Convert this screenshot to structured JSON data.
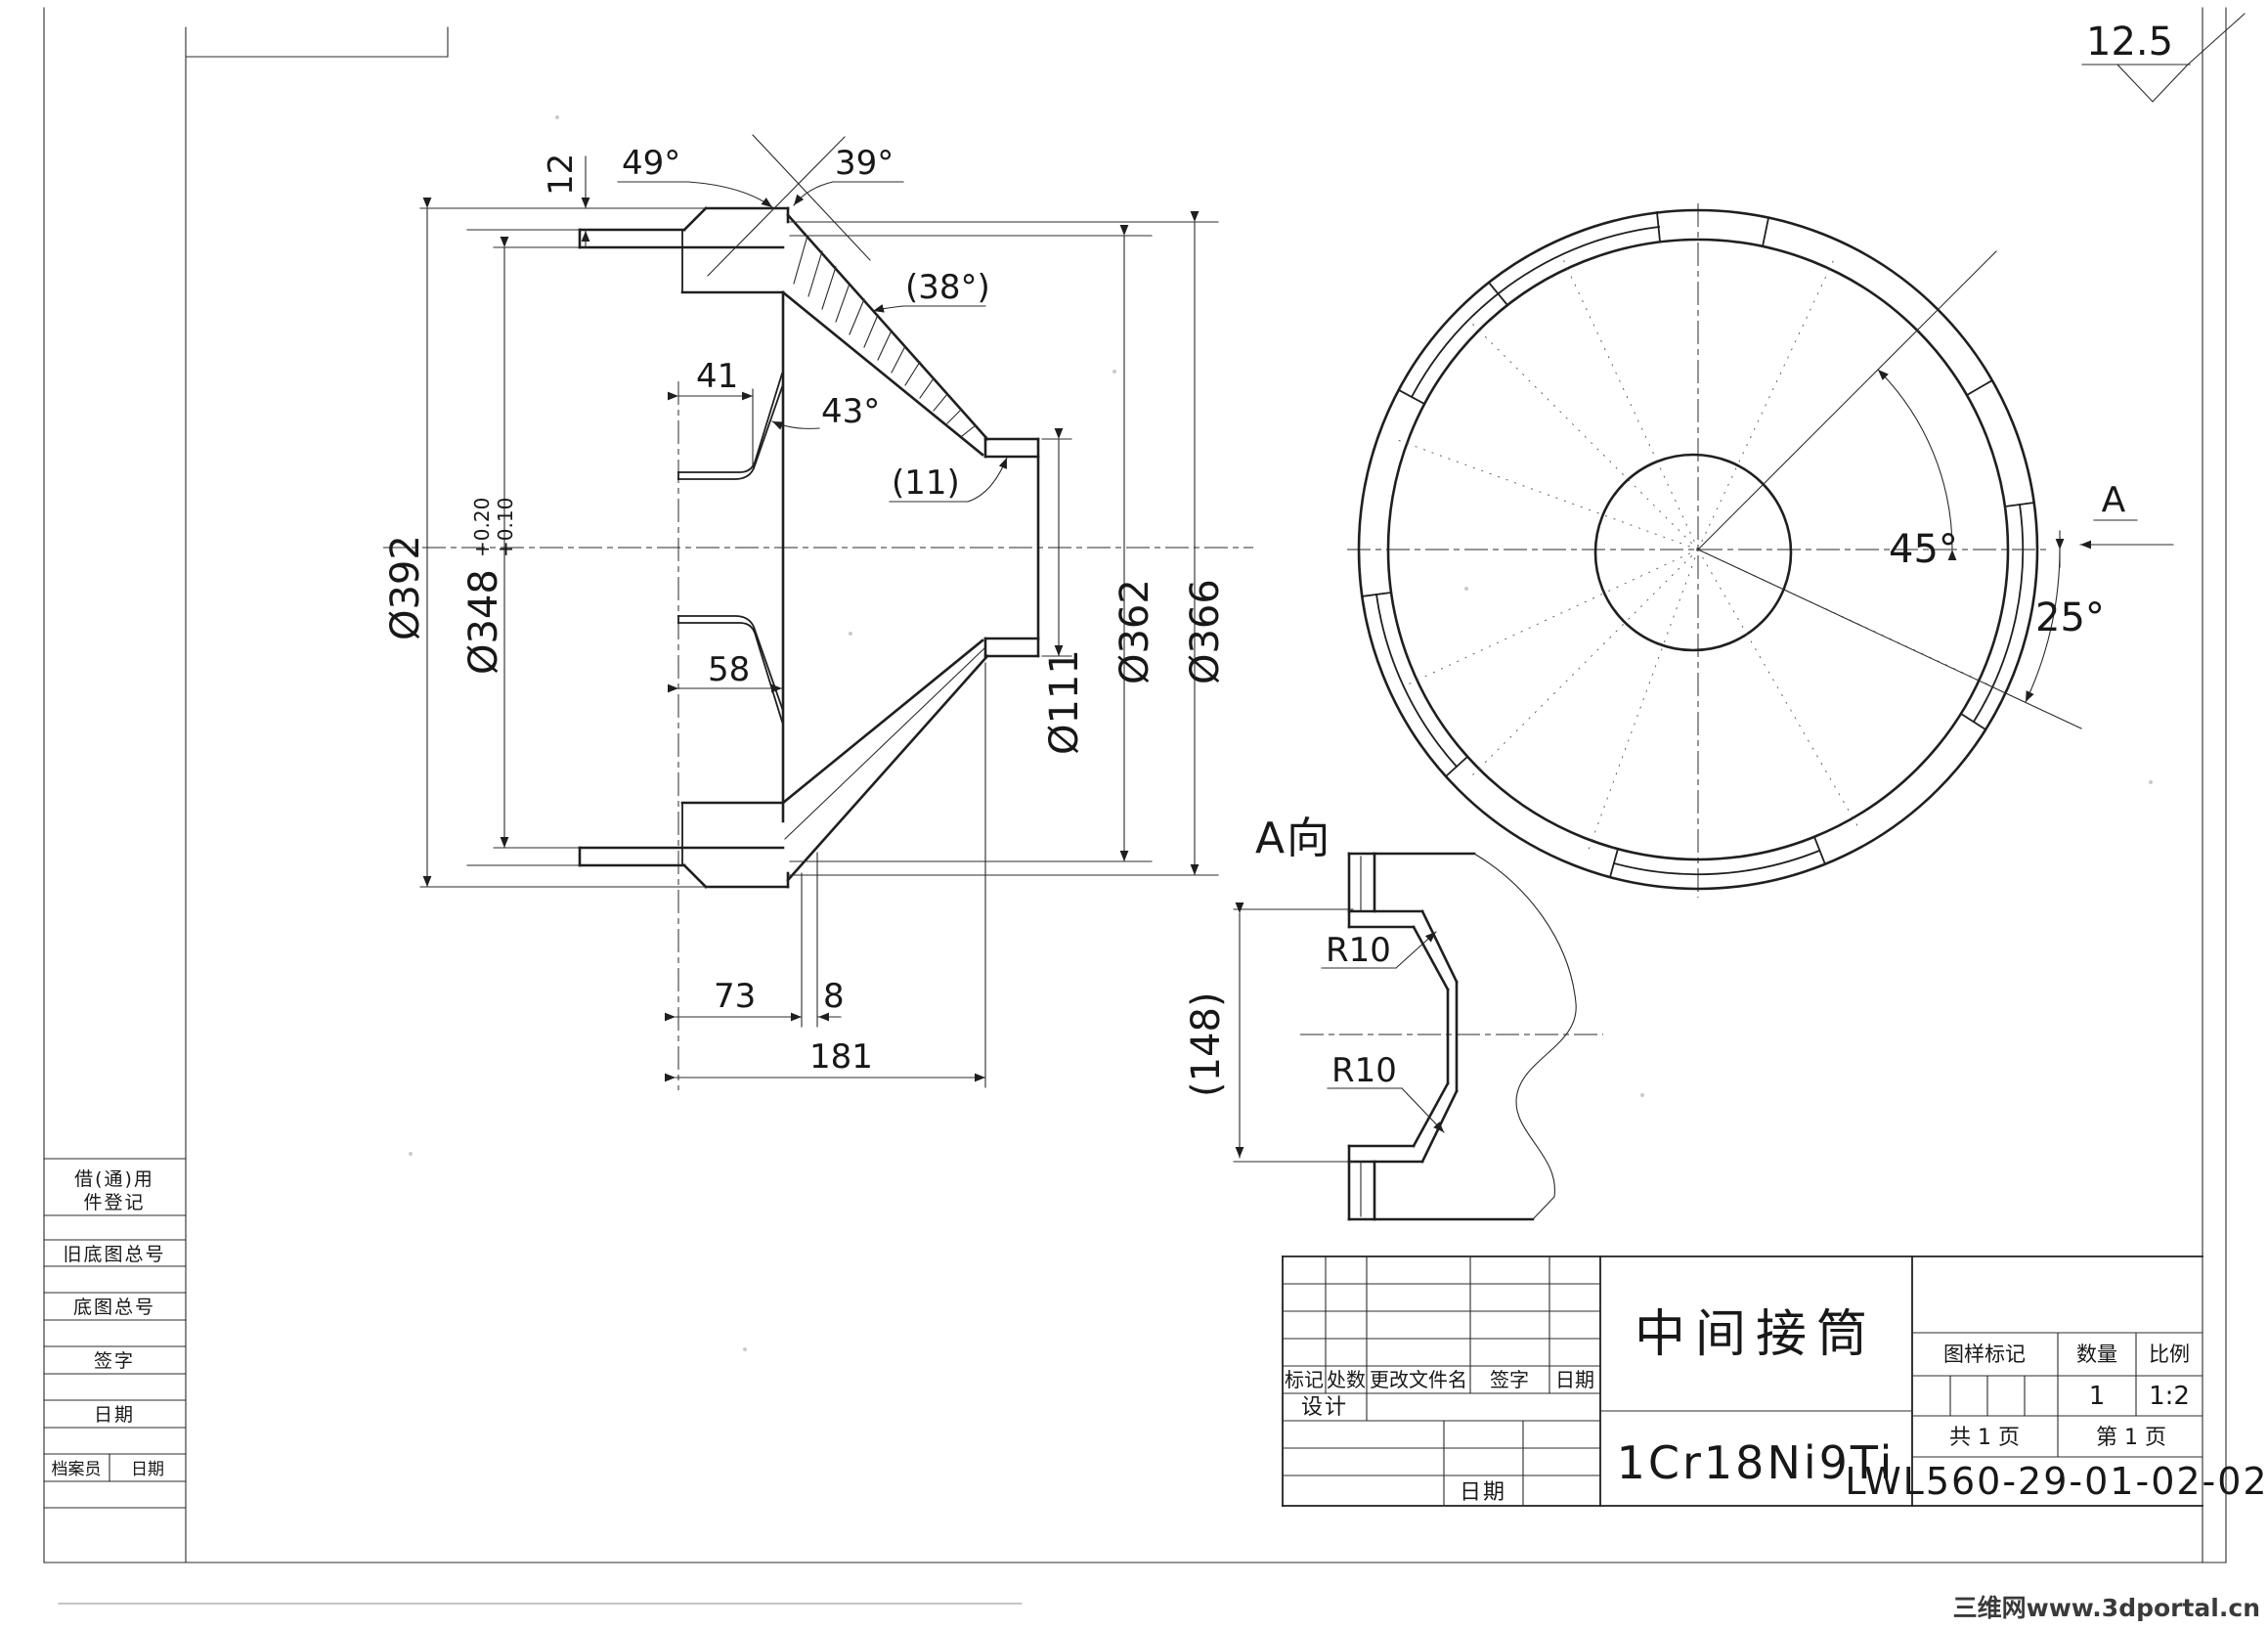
{
  "colors": {
    "ink": "#1f1f1f",
    "watermark_red": "#e04038",
    "paper": "#ffffff"
  },
  "surface_finish": {
    "roughness_value": "12.5"
  },
  "main_view": {
    "dim_12": "12",
    "angle_49": "49°",
    "angle_39": "39°",
    "angle_38": "(38°)",
    "dim_41": "41",
    "angle_43": "43°",
    "wall_11": "(11)",
    "dim_58": "58",
    "dim_73": "73",
    "dim_8": "8",
    "dim_181": "181",
    "dia_392": "Ø392",
    "dia_348": "Ø348",
    "dia_348_tol_up": "+0.20",
    "dia_348_tol_low": "+0.10",
    "dia_111": "Ø111",
    "dia_362": "Ø362",
    "dia_366": "Ø366"
  },
  "front_view": {
    "angle_45": "45°",
    "angle_25": "25°",
    "view_letter": "A"
  },
  "detail_view": {
    "label": "A向",
    "dim_148": "(148)",
    "radius_top": "R10",
    "radius_bottom": "R10"
  },
  "left_panel": {
    "row1_line1": "借(通)用",
    "row1_line2": "件登记",
    "row2": "旧底图总号",
    "row3": "底图总号",
    "row4": "签字",
    "row5": "日期",
    "row6_left": "档案员",
    "row6_right": "日期"
  },
  "title_block": {
    "rev_headers": [
      "标记",
      "处数",
      "更改文件名",
      "签字",
      "日期"
    ],
    "design_label": "设计",
    "date_label": "日期",
    "part_name": "中间接筒",
    "material": "1Cr18Ni9Ti",
    "stamp_label": "图样标记",
    "qty_label": "数量",
    "scale_label": "比例",
    "qty_value": "1",
    "scale_value": "1:2",
    "sheets_total": "共 1 页",
    "sheet_no": "第 1 页",
    "drawing_number": "LWL560-29-01-02-02"
  },
  "watermark": {
    "text": "三维网www.3dportal.cn"
  }
}
